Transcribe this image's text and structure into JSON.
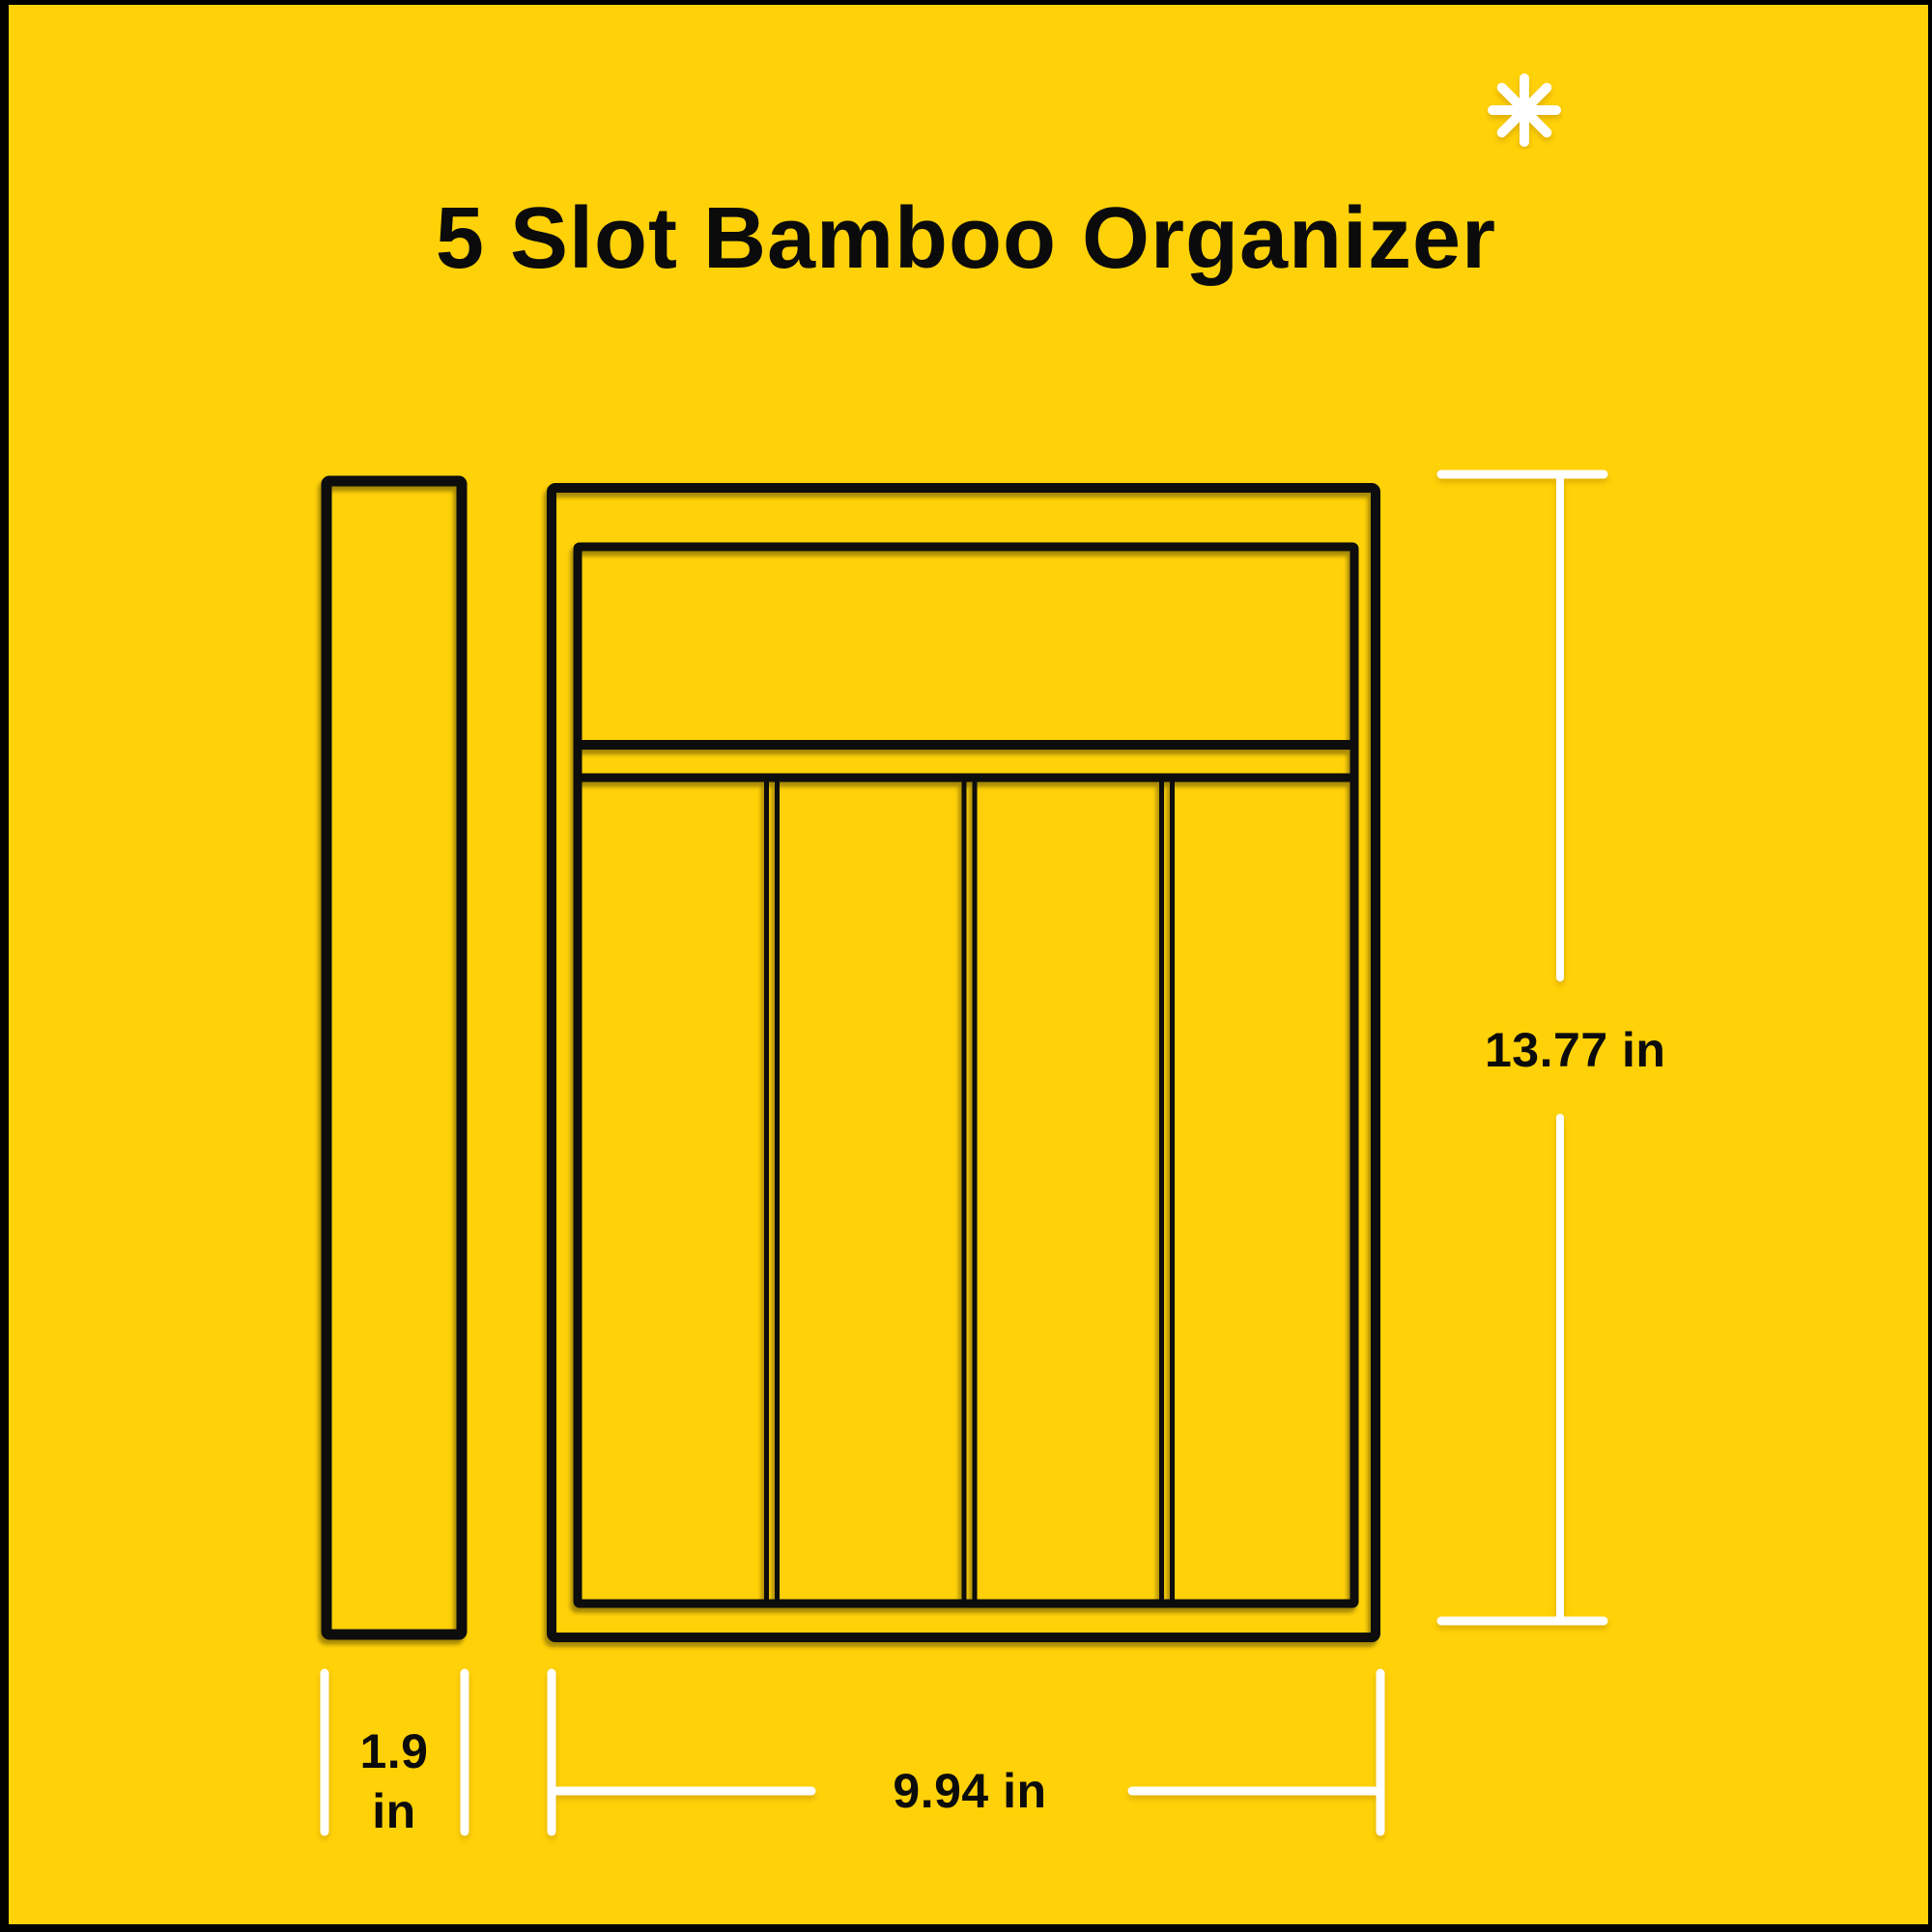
{
  "title": "5 Slot Bamboo Organizer",
  "asterisk_icon": "asterisk-starburst",
  "diagram": {
    "product": "5 Slot Bamboo Organizer",
    "slot_count": 5,
    "views": [
      "side-profile",
      "top-view"
    ]
  },
  "dimensions": {
    "depth_line1": "1.9",
    "depth_line2": "in",
    "height": "13.77 in",
    "width": "9.94 in"
  },
  "colors": {
    "background": "#FFD108",
    "outline": "#0A0A0A",
    "accent_white": "#FFFFFF",
    "frame": "#000000",
    "text": "#0B0B0B"
  }
}
